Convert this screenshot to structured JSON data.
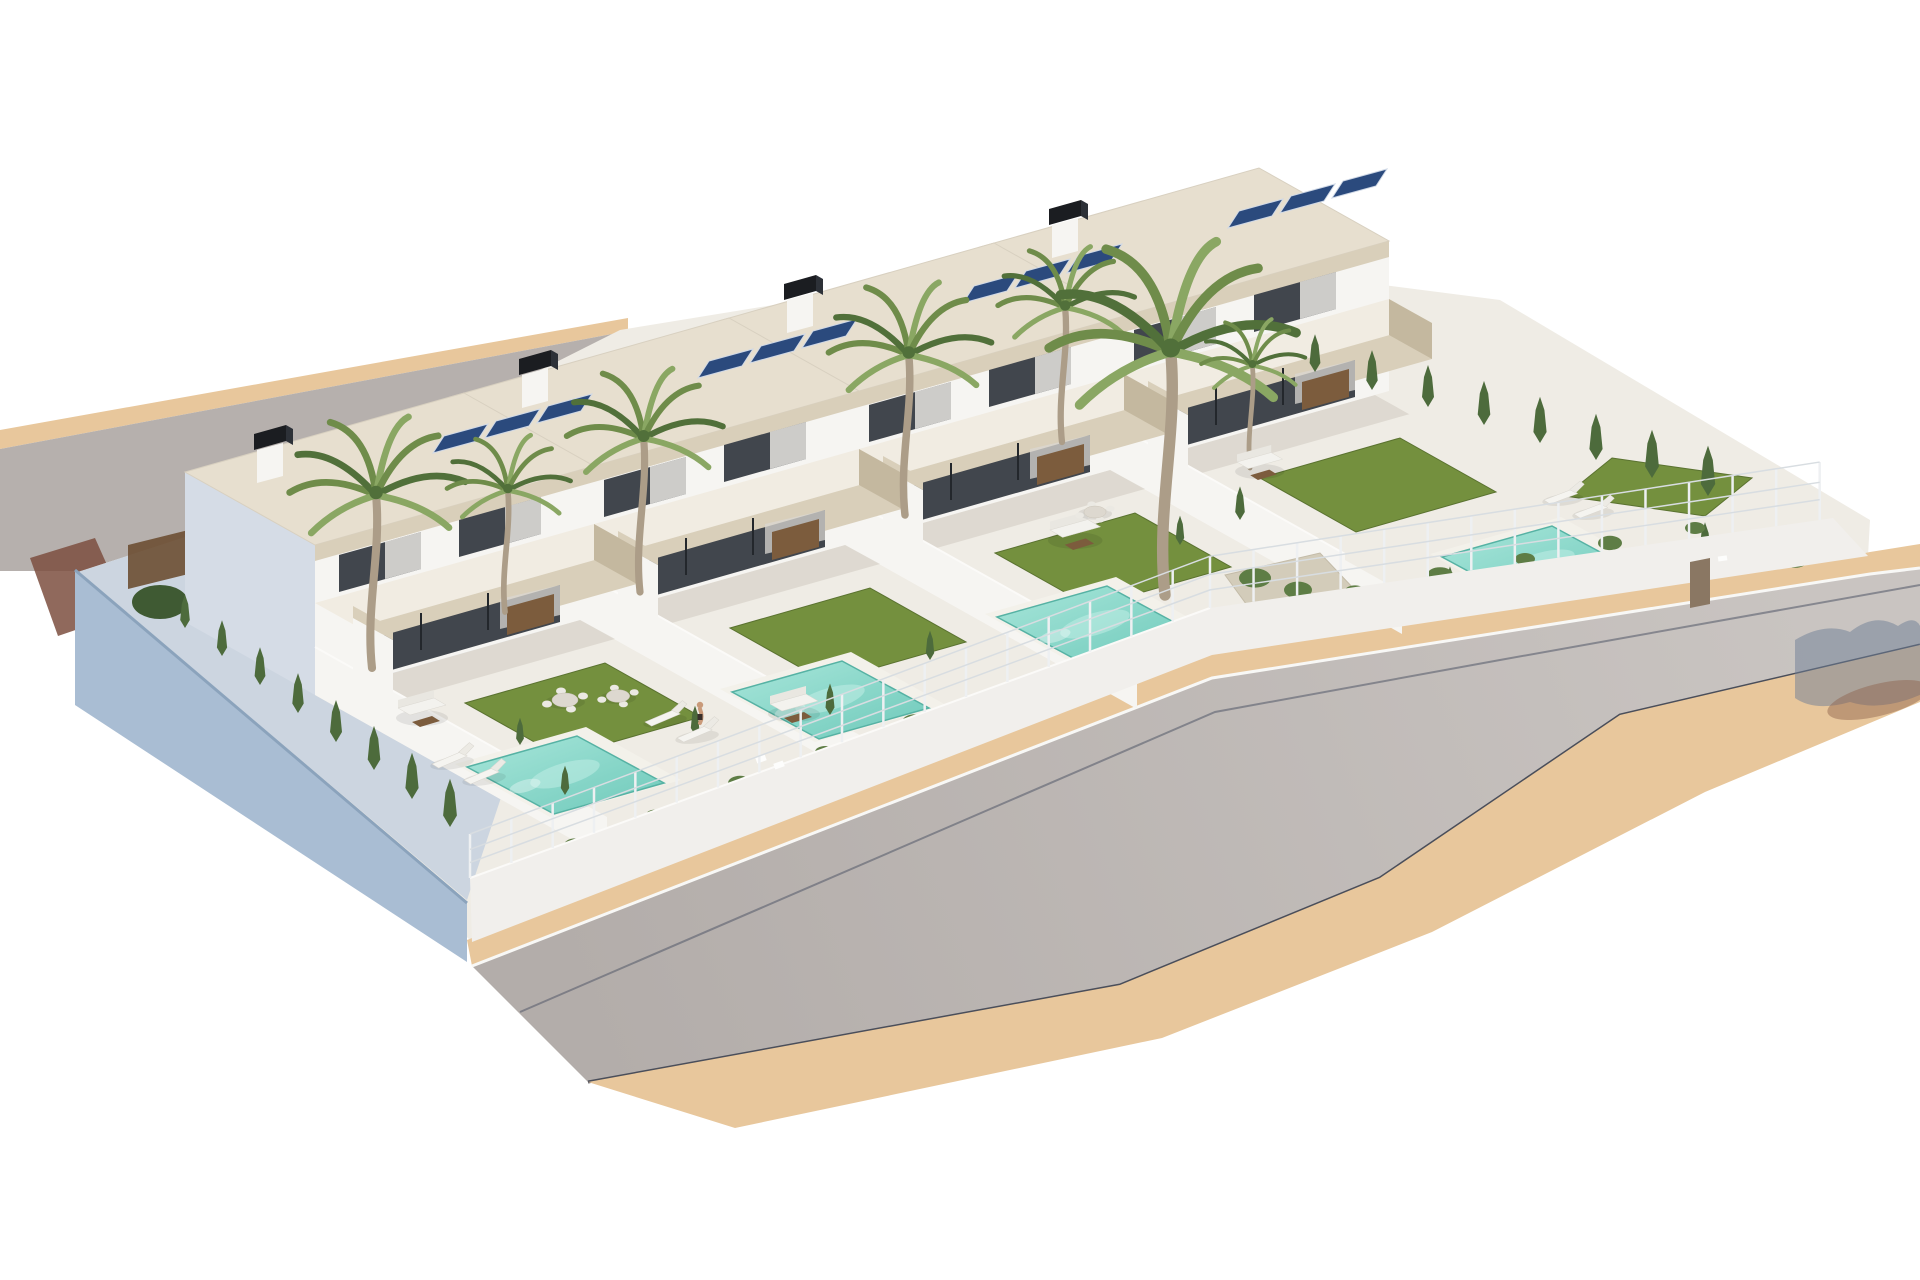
{
  "palette": {
    "bg": "#ffffff",
    "sand": "#e8c79c",
    "sand_edge": "#d8b488",
    "road": "#b6b0ad",
    "road_far": "#c9c4c1",
    "curb_dark": "#4a4e5a",
    "curb_white": "#f8f8f6",
    "wall_lit": "#f6f5f2",
    "wall_shadow": "#d5dce6",
    "wall_blue": "#a9bdd3",
    "wall_blue_dark": "#8ba3bc",
    "paving": "#efece5",
    "paving_shadow": "#c9c3b8",
    "stone": "#d9cfba",
    "stone_dark": "#c4b89f",
    "roof": "#e7dfcf",
    "glass": "#41464d",
    "wood": "#7c5c3d",
    "lawn": "#74903e",
    "lawn_dark": "#5a7230",
    "pool": "#7fd3c5",
    "pool_light": "#c5efe7",
    "pool_deep": "#56b2a4",
    "solar": "#2b4a7d",
    "chimney_black": "#1b1d21",
    "palm_green": "#6f8c4a",
    "palm_green_light": "#8aa763",
    "palm_green_dark": "#51703a",
    "trunk": "#ac9d88",
    "cypress": "#4d6b3c",
    "bush": "#5e7d45",
    "gravel": "#d3ccba",
    "slat_fence": "#6d4f33",
    "fence_white": "#eef0f2",
    "fence_wire": "#d8dde1",
    "shadow_blue": "#6d7e96",
    "shadow_brown": "#8c5f49",
    "skin": "#c99a7a",
    "gate": "#8a7763"
  },
  "scene": {
    "villa_count": 4,
    "pool_count": 4,
    "villas": [
      {
        "id": "villa-4",
        "tx": 1110,
        "ty": 470
      },
      {
        "id": "villa-3",
        "tx": 845,
        "ty": 545
      },
      {
        "id": "villa-2",
        "tx": 580,
        "ty": 620
      },
      {
        "id": "villa-1",
        "tx": 315,
        "ty": 695
      }
    ],
    "pools": [
      {
        "id": "pool-villa-1",
        "x": 455,
        "y": 764
      },
      {
        "id": "pool-villa-2",
        "x": 720,
        "y": 689
      },
      {
        "id": "pool-villa-3",
        "x": 985,
        "y": 614
      },
      {
        "id": "pool-villa-4",
        "x": 1430,
        "y": 554
      }
    ],
    "palms": [
      {
        "x": 372,
        "y": 668,
        "s": 1.35
      },
      {
        "x": 505,
        "y": 612,
        "s": 0.95
      },
      {
        "x": 640,
        "y": 592,
        "s": 1.2
      },
      {
        "x": 905,
        "y": 515,
        "s": 1.25
      },
      {
        "x": 1062,
        "y": 442,
        "s": 1.05
      },
      {
        "x": 1165,
        "y": 595,
        "s": 1.9
      },
      {
        "x": 1250,
        "y": 468,
        "s": 0.8
      }
    ],
    "cypresses": [
      {
        "x": 185,
        "y": 628,
        "s": 0.8
      },
      {
        "x": 222,
        "y": 656,
        "s": 0.85
      },
      {
        "x": 260,
        "y": 685,
        "s": 0.9
      },
      {
        "x": 298,
        "y": 713,
        "s": 0.95
      },
      {
        "x": 336,
        "y": 742,
        "s": 1.0
      },
      {
        "x": 374,
        "y": 770,
        "s": 1.05
      },
      {
        "x": 412,
        "y": 799,
        "s": 1.1
      },
      {
        "x": 450,
        "y": 827,
        "s": 1.15
      },
      {
        "x": 1315,
        "y": 372,
        "s": 0.9
      },
      {
        "x": 1372,
        "y": 390,
        "s": 0.95
      },
      {
        "x": 1428,
        "y": 407,
        "s": 1.0
      },
      {
        "x": 1484,
        "y": 425,
        "s": 1.05
      },
      {
        "x": 1540,
        "y": 443,
        "s": 1.1
      },
      {
        "x": 1596,
        "y": 460,
        "s": 1.1
      },
      {
        "x": 1652,
        "y": 478,
        "s": 1.15
      },
      {
        "x": 1708,
        "y": 496,
        "s": 1.2
      },
      {
        "x": 565,
        "y": 795,
        "s": 0.7
      },
      {
        "x": 695,
        "y": 735,
        "s": 0.7
      },
      {
        "x": 830,
        "y": 715,
        "s": 0.75
      },
      {
        "x": 930,
        "y": 660,
        "s": 0.7
      },
      {
        "x": 1240,
        "y": 520,
        "s": 0.8
      },
      {
        "x": 1180,
        "y": 545,
        "s": 0.7
      },
      {
        "x": 1450,
        "y": 600,
        "s": 0.8
      },
      {
        "x": 1705,
        "y": 560,
        "s": 0.9
      },
      {
        "x": 520,
        "y": 745,
        "s": 0.65
      }
    ],
    "bushes": [
      {
        "x": 575,
        "y": 845,
        "s": 1.1
      },
      {
        "x": 655,
        "y": 815,
        "s": 0.9
      },
      {
        "x": 740,
        "y": 783,
        "s": 1.2
      },
      {
        "x": 825,
        "y": 752,
        "s": 1.0
      },
      {
        "x": 915,
        "y": 722,
        "s": 1.3
      },
      {
        "x": 1005,
        "y": 692,
        "s": 0.9
      },
      {
        "x": 1095,
        "y": 662,
        "s": 1.2
      },
      {
        "x": 1185,
        "y": 632,
        "s": 1.0
      },
      {
        "x": 1270,
        "y": 610,
        "s": 1.4
      },
      {
        "x": 1355,
        "y": 592,
        "s": 1.1
      },
      {
        "x": 1440,
        "y": 575,
        "s": 1.3
      },
      {
        "x": 1525,
        "y": 559,
        "s": 1.0
      },
      {
        "x": 1610,
        "y": 543,
        "s": 1.2
      },
      {
        "x": 1695,
        "y": 528,
        "s": 1.0
      },
      {
        "x": 1255,
        "y": 578,
        "s": 1.6
      },
      {
        "x": 1298,
        "y": 590,
        "s": 1.4
      },
      {
        "x": 1335,
        "y": 603,
        "s": 1.5
      },
      {
        "x": 1279,
        "y": 607,
        "s": 1.2
      },
      {
        "x": 1760,
        "y": 545,
        "s": 1.5
      },
      {
        "x": 1795,
        "y": 560,
        "s": 1.3
      }
    ],
    "furniture": [
      {
        "type": "sofa",
        "x": 398,
        "y": 708,
        "rot": 0,
        "s": 1.0
      },
      {
        "type": "dining",
        "x": 565,
        "y": 700,
        "rot": 0,
        "s": 1.0
      },
      {
        "type": "lounger",
        "x": 432,
        "y": 764,
        "rot": -8,
        "s": 1.0
      },
      {
        "type": "lounger",
        "x": 464,
        "y": 780,
        "rot": -8,
        "s": 1.0
      },
      {
        "type": "lounger",
        "x": 645,
        "y": 722,
        "rot": -8,
        "s": 1.0
      },
      {
        "type": "lounger",
        "x": 677,
        "y": 738,
        "rot": -8,
        "s": 1.0
      },
      {
        "type": "sofa",
        "x": 770,
        "y": 704,
        "rot": 0,
        "s": 1.0
      },
      {
        "type": "dining",
        "x": 618,
        "y": 696,
        "rot": 0,
        "s": 0.9
      },
      {
        "type": "person",
        "x": 700,
        "y": 716,
        "rot": 0,
        "s": 1.0
      },
      {
        "type": "sofa",
        "x": 1050,
        "y": 530,
        "rot": 0,
        "s": 1.05
      },
      {
        "type": "dining",
        "x": 1095,
        "y": 512,
        "rot": 0,
        "s": 0.85
      },
      {
        "type": "sofa",
        "x": 1237,
        "y": 462,
        "rot": 0,
        "s": 0.95
      },
      {
        "type": "lounger",
        "x": 1544,
        "y": 500,
        "rot": -6,
        "s": 0.95
      },
      {
        "type": "lounger",
        "x": 1574,
        "y": 514,
        "rot": -6,
        "s": 0.95
      }
    ],
    "fence": {
      "points": [
        [
          470,
          878
        ],
        [
          1210,
          608
        ],
        [
          1833,
          518
        ]
      ],
      "post_spacing": 44,
      "height_start": 44,
      "height_end": 58
    }
  }
}
